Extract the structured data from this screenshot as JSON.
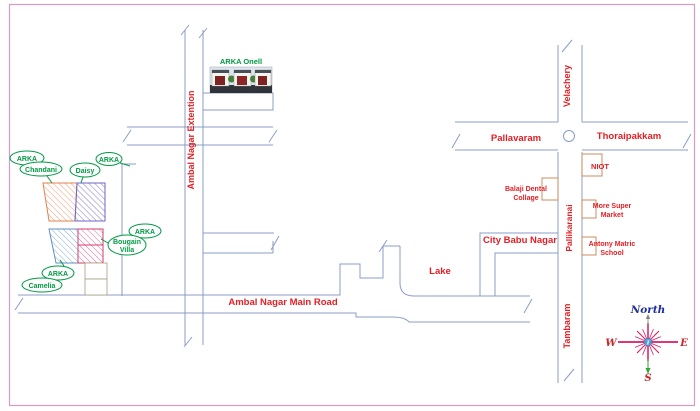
{
  "map": {
    "title_hint": "ARKA projects location map",
    "labels": {
      "extension": "Ambal Nagar Extention",
      "main_road": "Ambal Nagar Main Road",
      "velachery": "Velachery",
      "pallavaram": "Pallavaram",
      "thoraipakkam": "Thoraipakkam",
      "pallikaranai": "Pallikaranai",
      "tambaram": "Tambaram",
      "city_babu_nagar": "City Babu Nagar",
      "lake": "Lake"
    },
    "landmarks": {
      "niot": "NIOT",
      "balaji1": "Balaji Dental",
      "balaji2": "Collage",
      "market1": "More Super",
      "market2": "Market",
      "school1": "Antony Matric",
      "school2": "School"
    },
    "callouts": {
      "chandani_top": "ARKA",
      "chandani": "Chandani",
      "daisy_top": "ARKA",
      "daisy": "Daisy",
      "bougain_top": "ARKA",
      "bougain1": "Bougain",
      "bougain2": "Villa",
      "camelia_top": "ARKA",
      "camelia": "Camelia",
      "onell": "ARKA Onell"
    },
    "compass": {
      "north": "North",
      "west": "W",
      "east": "E",
      "south": "S",
      "center_glyph": "I"
    },
    "colors": {
      "road_line": "#8c9cc8",
      "label_red": "#e31e24",
      "label_green": "#009a44",
      "border_pink": "#d49bc8",
      "hatch_orange": "#ef9a76",
      "hatch_indigo": "#8078cc",
      "hatch_blue": "#86aed2",
      "hatch_pink": "#e8679a",
      "compass_ray": "#d81b60",
      "north_blue": "#1d2f9b",
      "wes_red": "#c62828"
    }
  }
}
